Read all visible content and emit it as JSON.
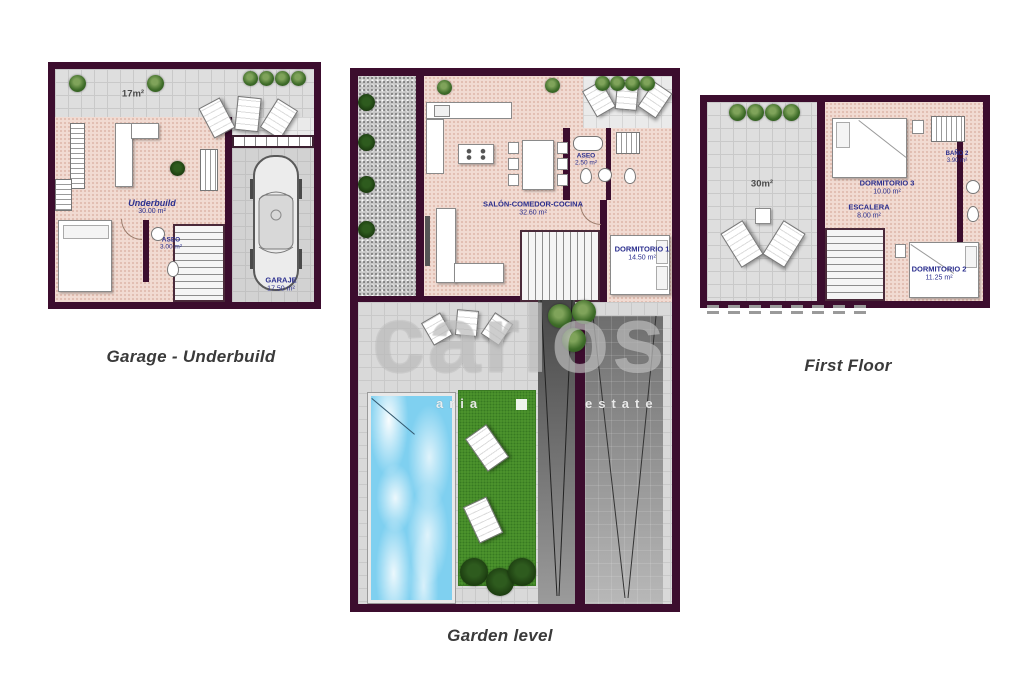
{
  "document": {
    "background": "#ffffff"
  },
  "colors": {
    "wall": "#3c0d2e",
    "room_label": "#2b2f8e",
    "pool_water": "#7fd0f0",
    "lawn": "#4f972f",
    "interior_floor": "#f1dbd2",
    "terrace_floor": "#dedede"
  },
  "plans": {
    "garage": {
      "title": "Garage - Underbuild",
      "terrace_area": "17m²",
      "underbuild": {
        "name": "Underbuild",
        "area": "30.00 m²"
      },
      "aseo": {
        "name": "ASEO",
        "area": "3.00 m²"
      },
      "garaje": {
        "name": "GARAJE",
        "area": "17.50 m²"
      }
    },
    "garden": {
      "title": "Garden level",
      "salon": {
        "name": "SALÓN-COMEDOR-COCINA",
        "area": "32.60 m²"
      },
      "aseo": {
        "name": "ASEO",
        "area": "2.50 m²"
      },
      "dormitorio1": {
        "name": "DORMITORIO 1",
        "area": "14.50 m²"
      }
    },
    "first": {
      "title": "First Floor",
      "terrace_area": "30m²",
      "dormitorio3": {
        "name": "DORMITORIO 3",
        "area": "10.00 m²"
      },
      "bano2": {
        "name": "BAÑO 2",
        "area": "3.90 m²"
      },
      "escalera": {
        "name": "ESCALERA",
        "area": "8.00 m²"
      },
      "dormitorio2": {
        "name": "DORMITORIO 2",
        "area": "11.25 m²"
      }
    }
  },
  "watermark": {
    "brand_fragment": "carlos",
    "small_fragment_left": "aria",
    "small_fragment_right": "estate"
  }
}
